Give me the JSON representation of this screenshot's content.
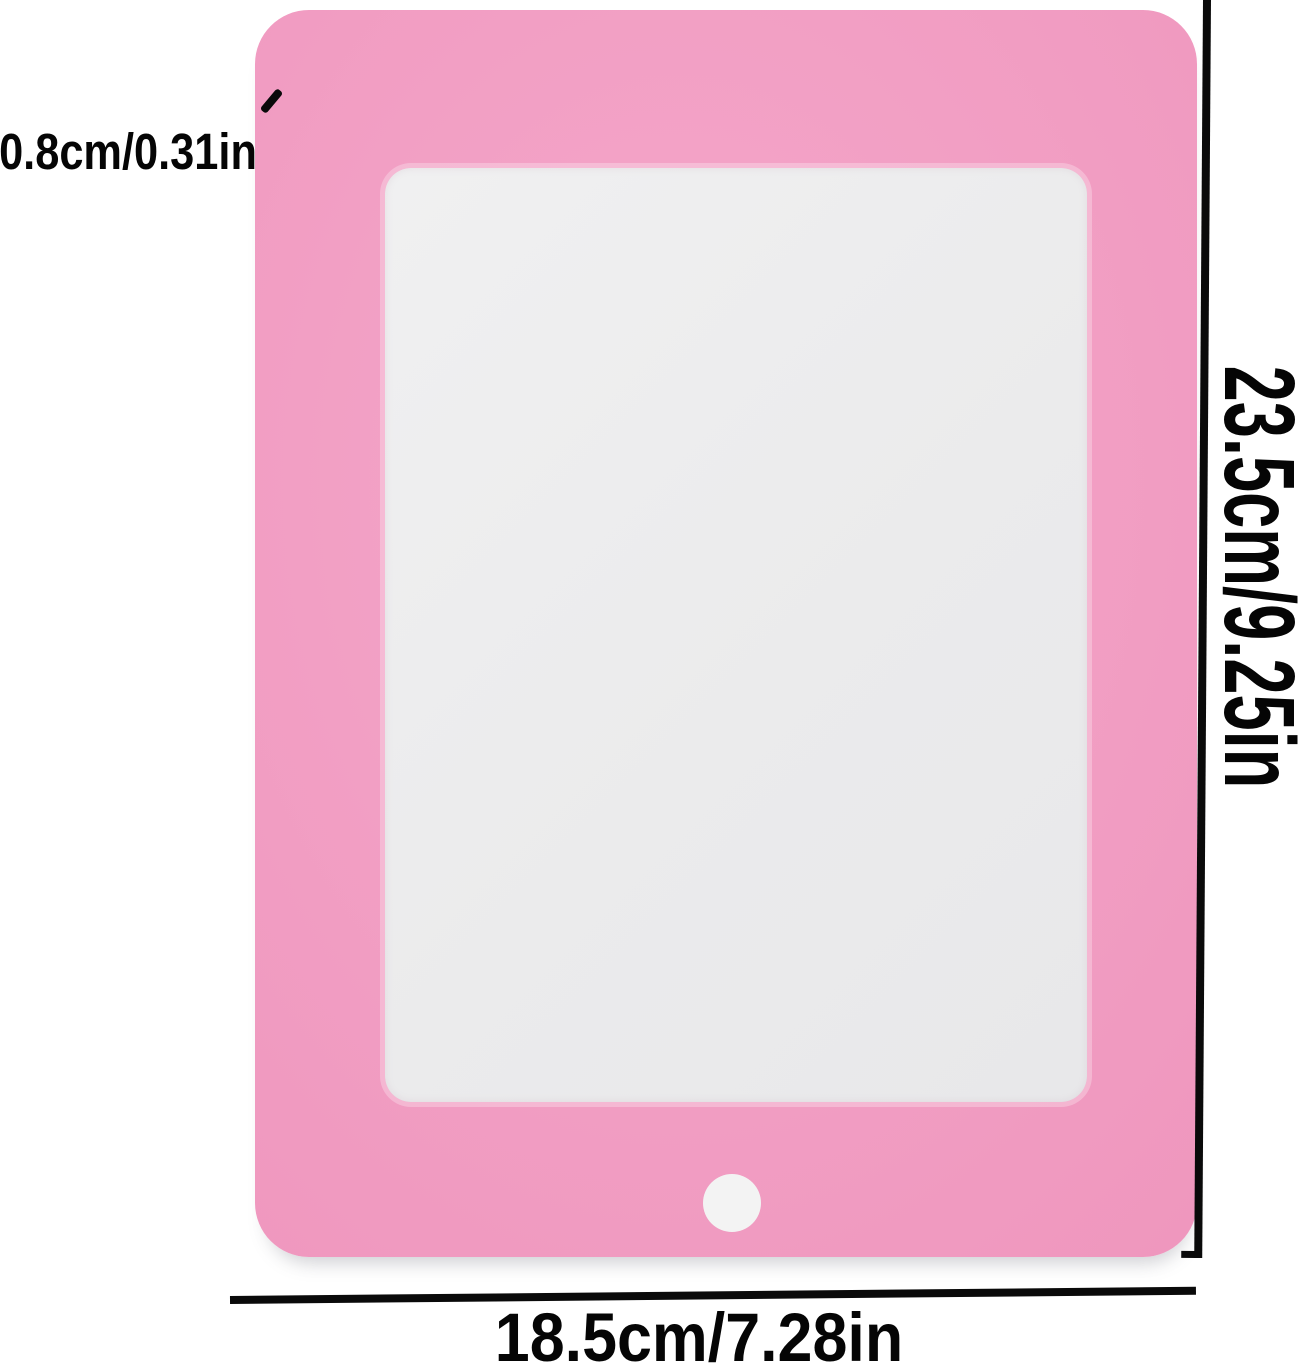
{
  "image_type": "product-dimension-diagram",
  "product": {
    "shape": "tablet-style photo frame with rounded corners, inner screen window and round home button"
  },
  "annotations": {
    "thickness_label": "0.8cm/0.31in",
    "height_label": "23.5cm/9.25in",
    "width_label": "18.5cm/7.28in"
  },
  "colors": {
    "frame_pink": "#f09ac0",
    "frame_pink_edge": "#ec8fb8",
    "frame_pink_highlight": "#f5a7ca",
    "screen_gray": "#ebebec",
    "home_button_white": "#f3f3f3",
    "dimension_line_black": "#0a0a0a",
    "background_white": "#ffffff",
    "label_text": "#050505"
  }
}
